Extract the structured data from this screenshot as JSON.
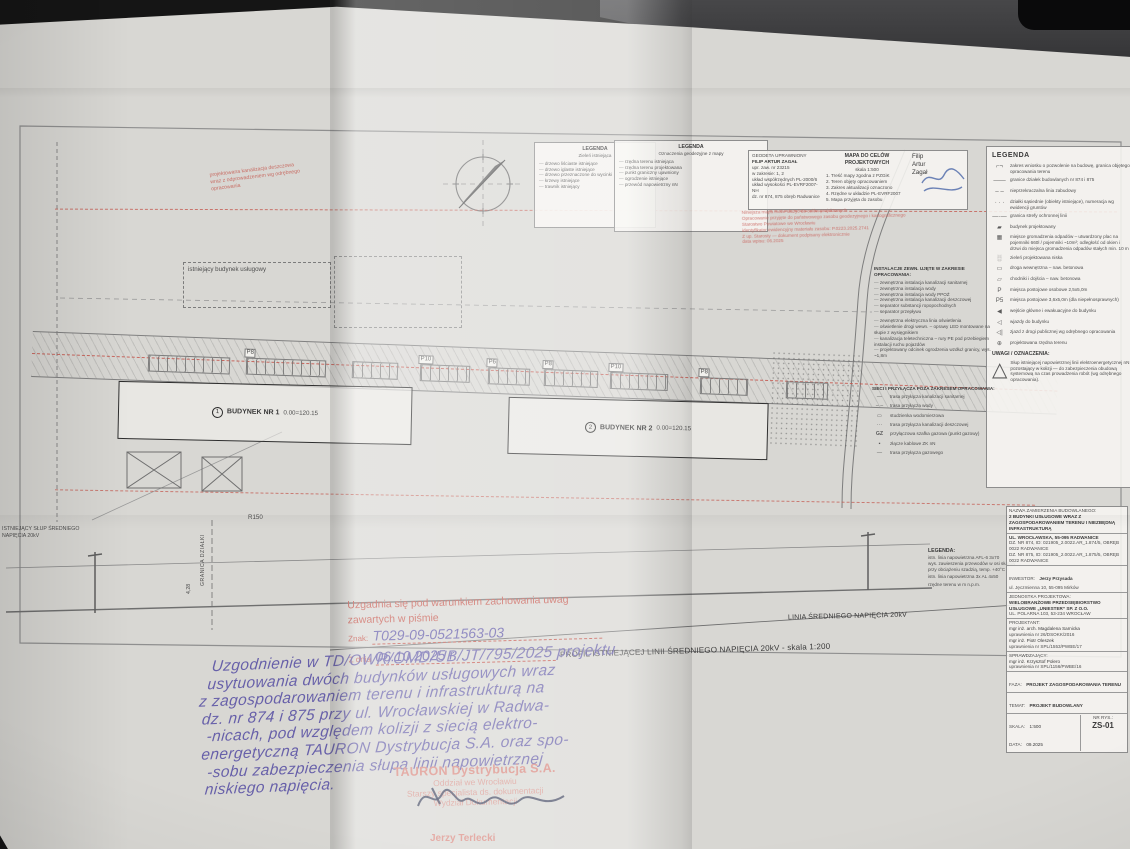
{
  "plan": {
    "building1": {
      "num": "1",
      "name": "BUDYNEK NR 1",
      "level": "0.00=120.15"
    },
    "building2": {
      "num": "2",
      "name": "BUDYNEK NR 2",
      "level": "0.00=120.15"
    },
    "existing_building": "istniejący budynek usługowy",
    "red_note_lines": [
      "projektowana kanalizacja deszczowa",
      "wraz z odprowadzeniem wg odrębnego",
      "opracowania"
    ],
    "radius_label": "R150",
    "parking_labels": [
      "P8",
      "P10",
      "P6",
      "P8",
      "P10",
      "P8"
    ],
    "boundary_label": "GRANICA DZIAŁKI",
    "dim_label": "4,28",
    "pole_note_line1": "ISTNIEJĄCY SŁUP ŚREDNIEGO",
    "pole_note_line2": "NAPIĘCIA 20kV",
    "sn_line_label": "LINIA ŚREDNIEGO NAPIĘCIA 20kV",
    "profile_title": "PROFIL ISTNIEJĄCEJ LINII ŚREDNIEGO NAPIĘCIA 20kV - skala 1:200"
  },
  "legend_green": {
    "title": "LEGENDA",
    "subtitle": "Zieleń istniejąca",
    "items": [
      "drzewo liściaste istniejące",
      "drzewo iglaste istniejące",
      "drzewo przeznaczone do wycinki",
      "krzewy istniejące",
      "trawnik istniejący"
    ]
  },
  "legend_geo": {
    "title": "LEGENDA",
    "subtitle": "Oznaczenia geodezyjne z mapy",
    "items": [
      "rzędna terenu istniejąca",
      "rzędna terenu projektowana",
      "punkt graniczny ujawniony",
      "ogrodzenie istniejące",
      "przewód napowietrzny nN"
    ]
  },
  "map_stamp": {
    "title": "MAPA DO CELÓW PROJEKTOWYCH",
    "subtitle": "skala 1:500",
    "left_lines": [
      "GEODETA UPRAWNIONY",
      "FILIP ARTUR ZAGAŁ",
      "upr. zaw. nr 23215",
      "w zakresie: 1, 2",
      "MAPA DO CELÓW PROJEKTOWYCH",
      "Skala 1:500",
      "układ współrzędnych PL-2000/6",
      "układ wysokości PL-EVRF2007-NH",
      "dz. nr 874, 875 obręb Radwanice"
    ],
    "mid_lines": [
      "1. Treść mapy zgodna z PZGiK",
      "2. Teren objęty opracowaniem",
      "3. Zakres aktualizacji oznaczono",
      "4. Rzędne w układzie PL-EVRF2007",
      "5. Mapa przyjęta do zasobu"
    ],
    "surveyor_lines": [
      "Filip",
      "Artur",
      "Zagał"
    ]
  },
  "clause_stamp": {
    "lines": [
      "Niniejsza mapa może służyć do celów projektowych",
      "Opracowanie przyjęte do państwowego zasobu geodezyjnego i kartograficznego",
      "Starostwo Powiatowe we Wrocławiu",
      "identyfikator ewidencyjny materiału zasobu: P.0223.2025.2741",
      "Z up. Starosty — dokument podpisany elektronicznie",
      "data wpisu: 06.2025"
    ]
  },
  "legend_main": {
    "title": "LEGENDA",
    "items": [
      {
        "s": "⌐¬",
        "t": "zakres wniosku o pozwolenie na budowę, granica objętego opracowania terenu"
      },
      {
        "s": "——",
        "t": "granice działek budowlanych nr 874 i 875"
      },
      {
        "s": "– –",
        "t": "nieprzekraczalna linia zabudowy"
      },
      {
        "s": "· · ·",
        "t": "działki sąsiednie (obiekty istniejące), numeracja wg ewidencji gruntów"
      },
      {
        "s": "—·—",
        "t": "granica strefy ochronnej linii"
      },
      {
        "s": "▰",
        "t": "budynek projektowany"
      },
      {
        "s": "▦",
        "t": "miejsce gromadzenia odpadów – utwardzony plac na pojemniki 660l / pojemniki ~10m²; odległość od okien i drzwi do miejsca gromadzenia odpadów stałych min. 10 m"
      },
      {
        "s": "░",
        "t": "zieleń projektowana niska"
      },
      {
        "s": "▭",
        "t": "droga wewnętrzna – naw. betonowa"
      },
      {
        "s": "▱",
        "t": "chodniki i dojścia – naw. betonowa"
      },
      {
        "s": "P",
        "t": "miejsca postojowe osobowe 2,5x5,0m"
      },
      {
        "s": "P5",
        "t": "miejsca postojowe 3,6x5,0m (dla niepełnosprawnych)"
      },
      {
        "s": "◀",
        "t": "wejście główne i ewakuacyjne do budynku"
      },
      {
        "s": "◁",
        "t": "wjazdy do budynku"
      },
      {
        "s": "◁|",
        "t": "zjazd z drogi publicznej wg odrębnego opracowania"
      },
      {
        "s": "⊕",
        "t": "projektowana rzędna terenu"
      }
    ]
  },
  "uwagi": {
    "title": "UWAGI / OZNACZENIA:",
    "symbol": "△",
    "note": "Słup istniejącej napowietrznej linii elektroenergetycznej nN pozostający w kolizji — do zabezpieczenia obudową systemową na czas prowadzenia robót (wg odrębnego opracowania)."
  },
  "legend_inst": {
    "title": "INSTALACJE ZEWN. UJĘTE W ZAKRESIE OPRACOWANIA:",
    "items": [
      "zewnętrzna instalacja kanalizacji sanitarnej",
      "zewnętrzna instalacja wody",
      "zewnętrzna instalacja wody PPOŻ",
      "zewnętrzna instalacja kanalizacji deszczowej",
      "separator substancji ropopochodnych",
      "separator przepływu",
      "zewnętrzna elektryczna linia oświetlenia",
      "oświetlenie drogi wewn. – oprawy LED montowane na słupie z wysięgnikiem",
      "kanalizacja teletechniczna – rury PE pod przebiegiem instalacji ruchu pojazdów",
      "projektowany odcinek ogrodzenia wzdłuż granicy, wys. ~1,8m"
    ]
  },
  "legend_sieci": {
    "title": "SIECI I PRZYŁĄCZA POZA ZAKRESEM OPRACOWANIA:",
    "items": [
      {
        "s": "—",
        "t": "trasa przyłącza kanalizacji sanitarnej"
      },
      {
        "s": "– –",
        "t": "trasa przyłącza wody"
      },
      {
        "s": "▭",
        "t": "studzienka wodomierzowa"
      },
      {
        "s": "···",
        "t": "trasa przyłącza kanalizacji deszczowej"
      },
      {
        "s": "GZ",
        "t": "przyłączowa szafka gazowa (punkt gazowy)"
      },
      {
        "s": "▪",
        "t": "złącze kablowe ZK nN"
      },
      {
        "s": "—",
        "t": "trasa przyłącza gazowego"
      }
    ]
  },
  "profile_legend": {
    "title": "LEGENDA:",
    "items": [
      "istn. linia napowietrzna AFL-6 3x70",
      "wys. zawieszenia przewodów w osi słupów",
      "przy obciążeniu szadzią, temp. +40°C",
      "istn. linia napowietrzna 3x AL 4x50",
      "rzędne terenu w m n.p.m."
    ]
  },
  "title_block": {
    "obj_label": "NAZWA ZAMIERZENIA BUDOWLANEGO:",
    "obj_name": "2 BUDYNKI USŁUGOWE WRAZ Z ZAGOSPODAROWANIEM TERENU I NIEZBĘDNĄ INFRASTRUKTURĄ",
    "addr1": "UL. WROCŁAWSKA, 55-095 RADWANICE",
    "addr2": "DZ. NR 874, ID: 021905_2.0022.AR_1.874/5, OBRĘB 0022 RADWANICE",
    "addr3": "DZ. NR 875, ID: 021905_2.0022.AR_1.875/5, OBRĘB 0022 RADWANICE",
    "inv_label": "INWESTOR:",
    "inv_name": "Jerzy Przysada",
    "inv_addr": "ul. Jęczmienna 10, 55-095 Mirków",
    "unit_label": "JEDNOSTKA PROJEKTOWA:",
    "unit_name": "WIELOBRANŻOWE PRZEDSIĘBIORSTWO USŁUGOWE „UNIESTER” SP. Z O.O.",
    "unit_addr": "UL. POLARNA 103, 53-234 WROCŁAW",
    "designer_label": "PROJEKTANT:",
    "designer1": "mgr inż. arch. Magdalena Sarnicka",
    "designer1_lic": "uprawnienia nr 26/DSOKK/2016",
    "designer2": "mgr inż. Piotr Oleszek",
    "designer2_lic": "uprawnienia nr SPL/1553/PWBE/17",
    "checker_label": "SPRAWDZAJĄCY:",
    "checker": "mgr inż. Krzysztof Polero",
    "checker_lic": "uprawnienia nr SPL/1156/PWBE/16",
    "stage_label": "FAZA:",
    "stage": "PROJEKT ZAGOSPODAROWANIA TERENU",
    "subject_label": "TEMAT:",
    "subject": "PROJEKT BUDOWLANY",
    "scale_label": "SKALA:",
    "scale": "1:500",
    "date_label": "DATA:",
    "date": "09.2025",
    "sheet_label": "NR RYS.:",
    "sheet": "ZS-01"
  },
  "approval": {
    "line1": "Uzgadnia się pod warunkiem zachowania uwag",
    "line2": "zawartych w piśmie",
    "znak_label": "Znak:",
    "znak_value": "T029-09-0521563-03",
    "date_label": "Z dnia",
    "date_value": "06.10.2025 r."
  },
  "handwriting": {
    "lines": [
      "Uzgodnienie w TD/OWR/OMD/UB/JT/795/2025 projektu",
      "usytuowania dwóch budynków usługowych wraz",
      "z zagospodarowaniem terenu i infrastrukturą na",
      "dz. nr 874 i 875 przy ul. Wrocławskiej w Radwa-",
      "-nicach, pod względem kolizji z siecią elektro-",
      "energetyczną TAURON Dystrybucja S.A. oraz spo-",
      "-sobu zabezpieczenia słupa linii napowietrznej",
      "niskiego napięcia."
    ]
  },
  "tauron_stamp": {
    "company": "TAURON Dystrybucja S.A.",
    "branch": "Oddział we Wrocławiu",
    "role": "Starszy specjalista ds. dokumentacji",
    "dept": "Wydział Dokumentacji",
    "signer": "Jerzy Terlecki"
  }
}
